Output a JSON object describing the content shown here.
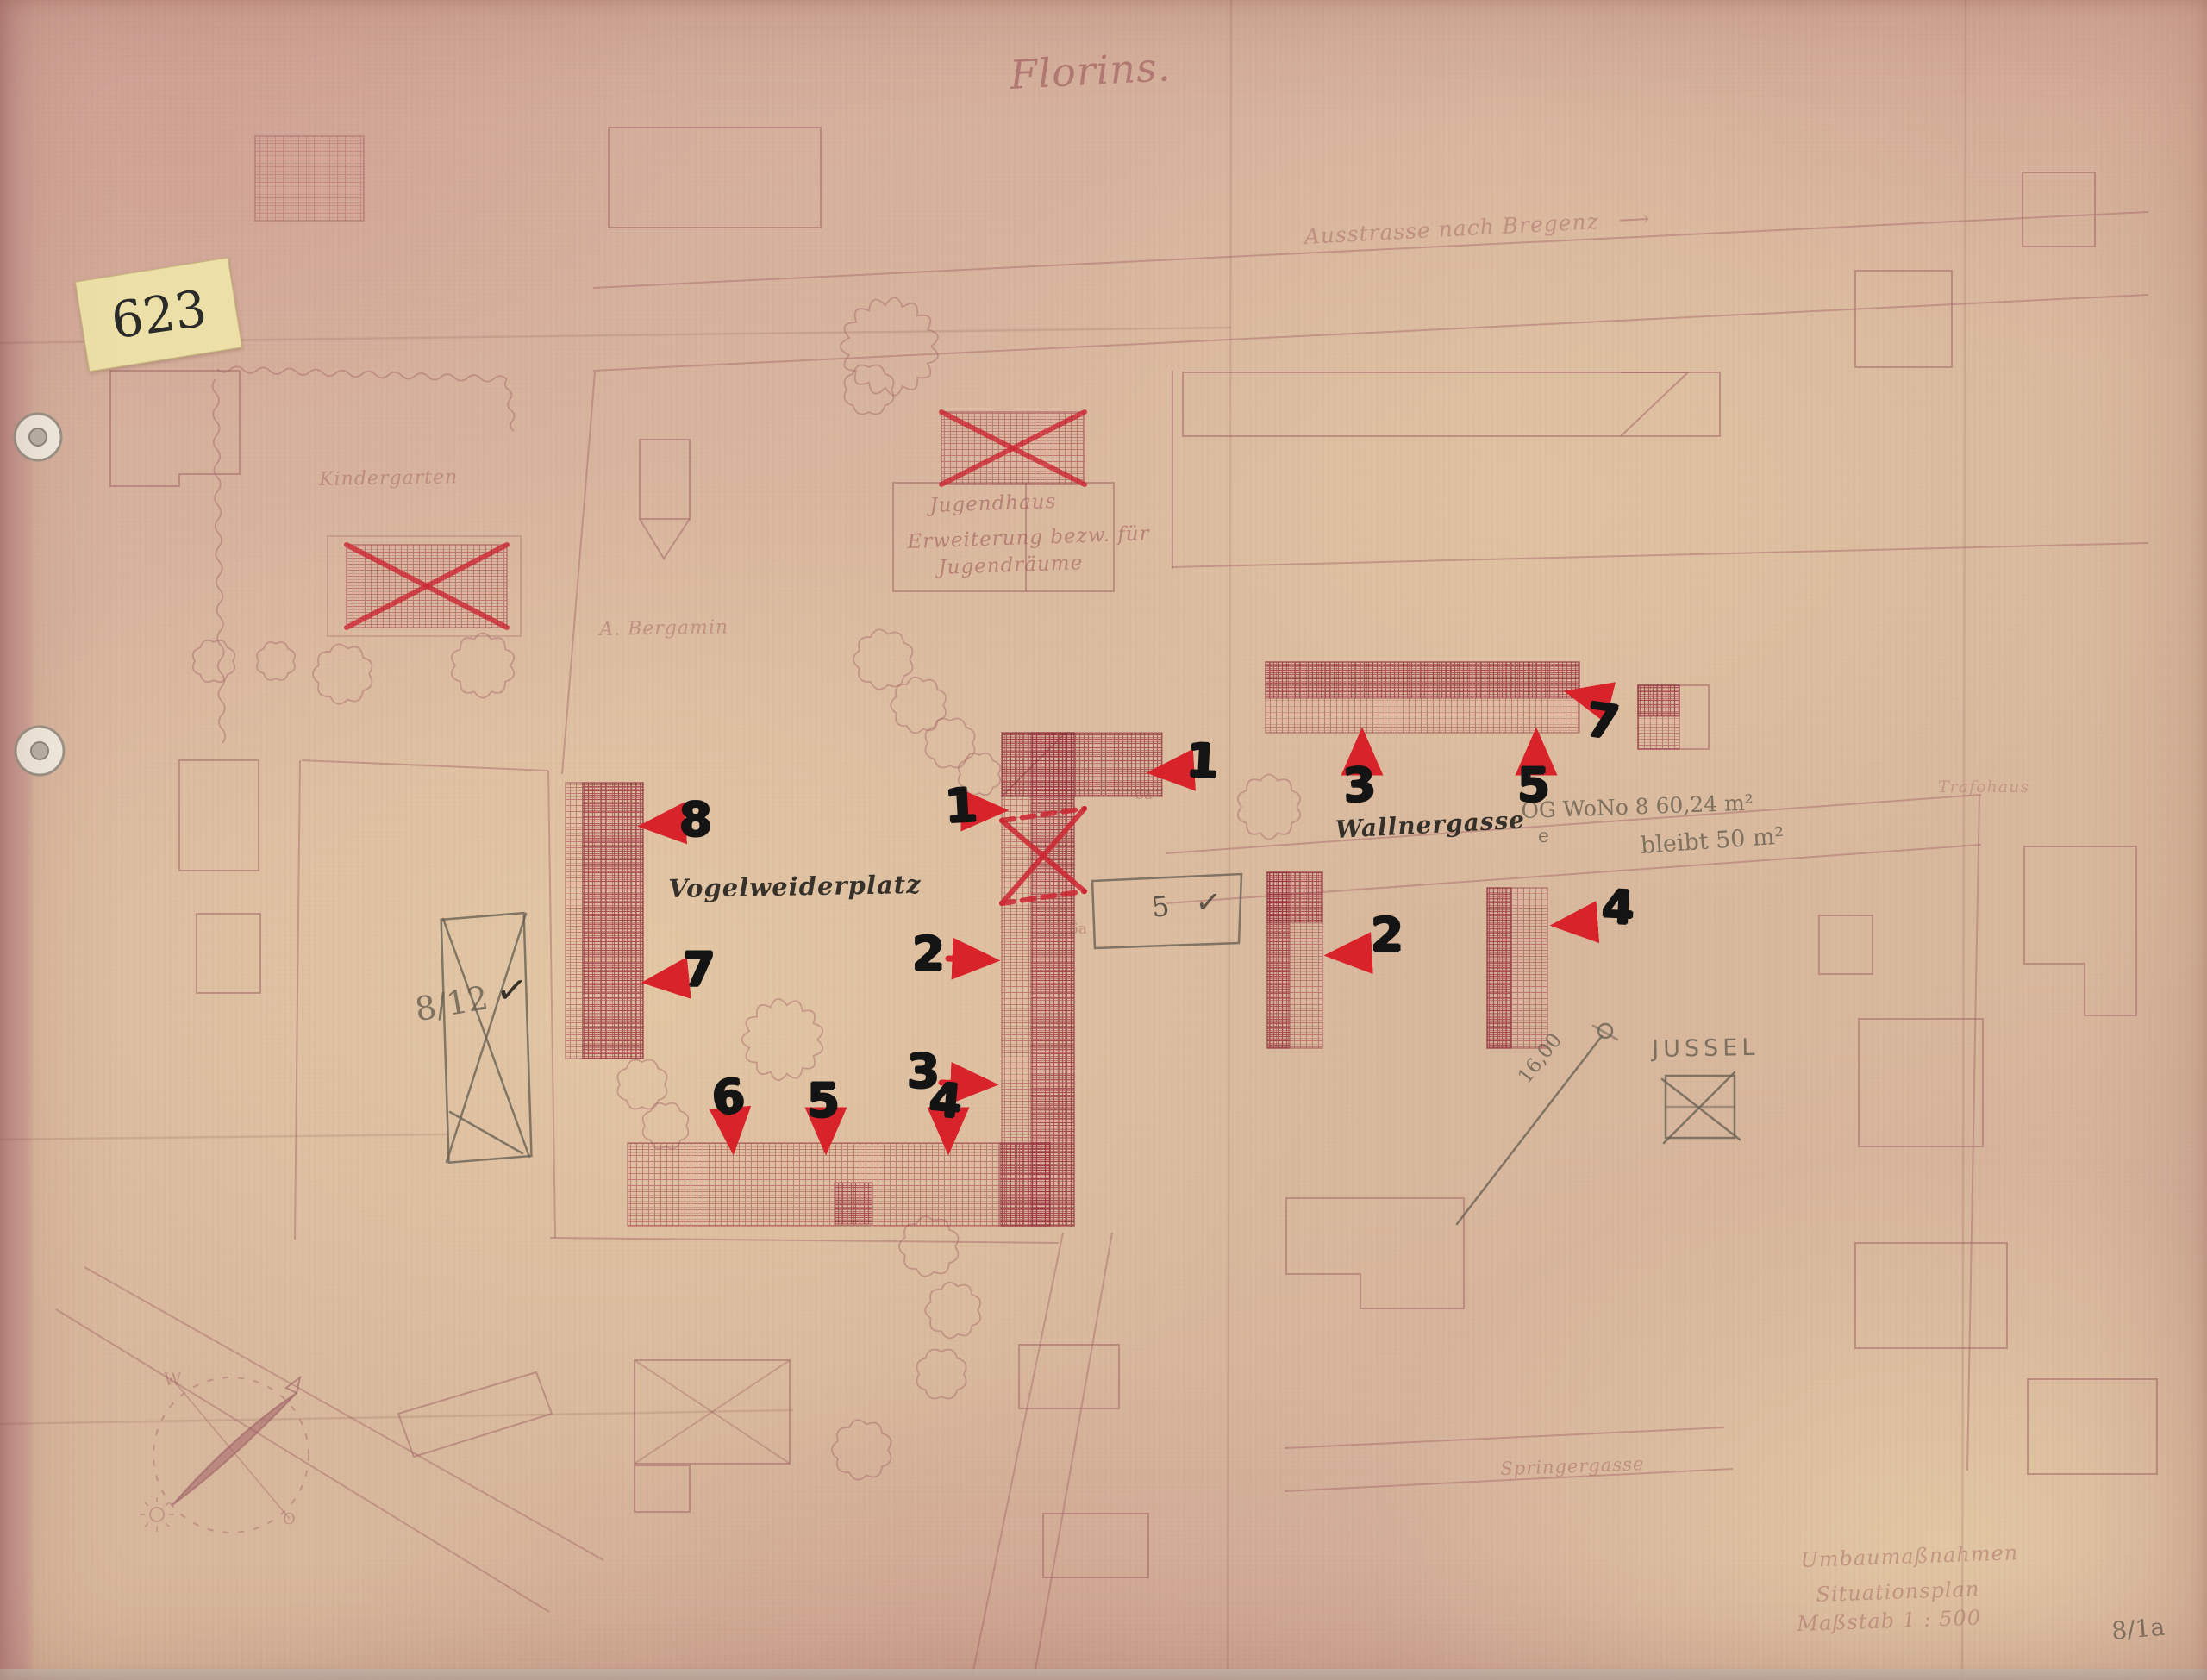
{
  "document": {
    "archive_number": "623",
    "sheet_number": "8/1a",
    "title": "Florins."
  },
  "labels": {
    "top_road": "Ausstrasse nach Bregenz",
    "top_road_arrow": "⟶",
    "kindergarten": "Kindergarten",
    "youth_house_line1": "Jugendhaus",
    "youth_house_line2": "Erweiterung bezw. für",
    "youth_house_line3": "Jugendräume",
    "owner_name": "A. Bergamin",
    "wall_gasse": "Wallnergasse",
    "platz": "Vogelweiderplatz",
    "trafo": "Trafohaus",
    "bottom_gasse": "Springergasse",
    "jussel": "JUSSEL",
    "parcel_6a_top": "6a",
    "parcel_6a_side": "6a"
  },
  "pencil_notes": {
    "flat_line1": "OG  WoNo 8   60,24 m²",
    "flat_e": "e",
    "flat_line2": "bleibt 50 m²",
    "dimension": "16,00",
    "parcel": "8/12",
    "parcel_check": "✓",
    "box_digit": "5",
    "box_check": "✓"
  },
  "title_block": {
    "line1": "Umbaumaßnahmen",
    "line2": "Situationsplan",
    "line3": "Maßstab   1 : 500"
  },
  "compass": {
    "west": "W",
    "east": "O"
  },
  "markers": {
    "u_top_1": "1",
    "u_left_1": "1",
    "u_left_2": "2",
    "u_left_3": "3",
    "u_bottom_4": "4",
    "u_bottom_5": "5",
    "u_bottom_6": "6",
    "u_west_7": "7",
    "u_west_8": "8",
    "row_3": "3",
    "row_5": "5",
    "row_7": "7",
    "mid_2": "2",
    "east_4": "4"
  },
  "colors": {
    "marker_red": "#d8232a",
    "hatch_red": "#a23a49",
    "ink_black": "#1f1d1b",
    "pencil_gray": "#6f675c",
    "note_yellow": "#ece0a8",
    "paper": "#d9b99b"
  }
}
